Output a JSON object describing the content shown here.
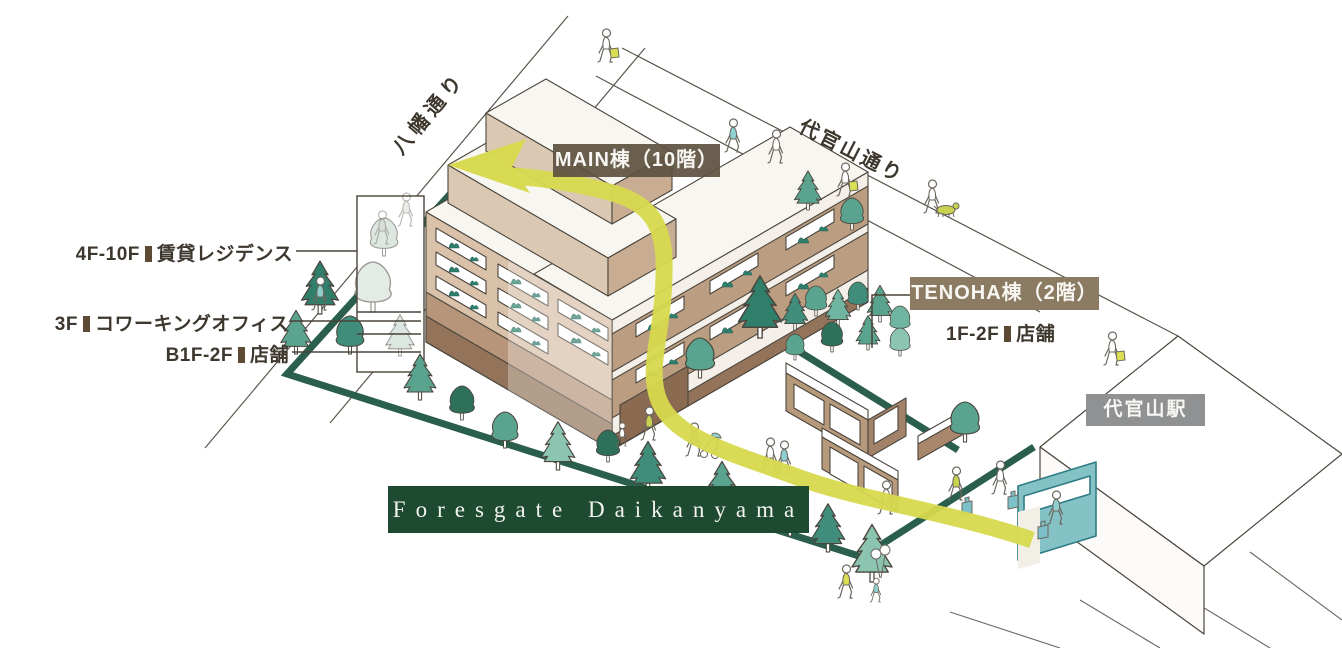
{
  "streets": {
    "hachiman": "八幡通り",
    "daikanyama": "代官山通り"
  },
  "main_building": {
    "label": "MAIN棟（10階）",
    "floors": [
      {
        "range": "4F-10F",
        "use": "賃貸レジデンス"
      },
      {
        "range": "3F",
        "use": "コワーキングオフィス"
      },
      {
        "range": "B1F-2F",
        "use": "店舗"
      }
    ]
  },
  "tenoha_building": {
    "label": "TENOHA棟（2階）",
    "floors": [
      {
        "range": "1F-2F",
        "use": "店舗"
      }
    ]
  },
  "station": {
    "label": "代官山駅"
  },
  "site_banner": {
    "label": "Foresgate Daikanyama"
  },
  "colors": {
    "banner_green": "#1d4a31",
    "boundary_green": "#2a5f4e",
    "route_yellow": "#d7d94e",
    "main_label_brown": "#5d503f",
    "tenoha_label_brown": "#8c7b63",
    "station_label_gray": "#8f9192",
    "building_tan": "#d9c1aa",
    "tree_teal": "#5aa48f"
  }
}
